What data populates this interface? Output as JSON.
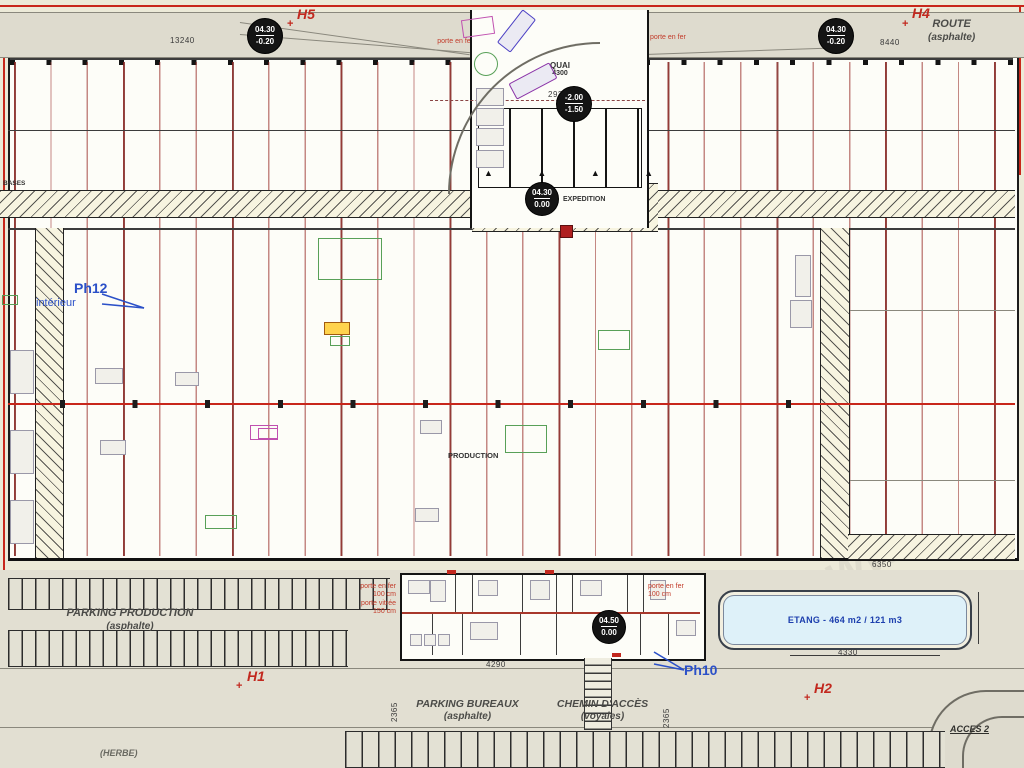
{
  "colors": {
    "accent_red": "#c2281e",
    "grid_red": "#962823",
    "marker_blue": "#2b50c8",
    "pond_fill": "#def1f9",
    "pond_text": "#1d3fae",
    "paper": "#ecead8",
    "asphalt": "#dedbce"
  },
  "watermark": "www",
  "route": {
    "label": "ROUTE",
    "sub": "(asphalte)"
  },
  "markers": {
    "h5": "H5",
    "h4": "H4",
    "h1": "H1",
    "h2": "H2",
    "ph12": "Ph12",
    "ph12_sub": "intérieur",
    "ph10": "Ph10",
    "cross": "+"
  },
  "levels": {
    "top_left": {
      "a": "04.30",
      "b": "-0.20"
    },
    "top_right": {
      "a": "04.30",
      "b": "-0.20"
    },
    "dock": {
      "a": "-2.00",
      "b": "-1.50"
    },
    "entry": {
      "a": "04.30",
      "b": "0.00"
    },
    "bureaux": {
      "a": "04.50",
      "b": "0.00"
    }
  },
  "dims": {
    "top_left": "13240",
    "dock_top": "2922",
    "top_right": "8440",
    "quai": "4300",
    "right_wing": "6350",
    "parking_small": "400",
    "bureaux": "4290",
    "pond": "4330",
    "v_left": "2365",
    "v_right": "2365"
  },
  "doors": {
    "top_left": "porte en fer",
    "top_right": "porte en fer",
    "b_left1": "porte en fer",
    "b_left1s": "100 cm",
    "b_left2": "porte vitrée",
    "b_left2s": "150 cm",
    "b_right": "porte en fer",
    "b_rights": "100 cm"
  },
  "zones": {
    "parking_production": {
      "label": "PARKING PRODUCTION",
      "sub": "(asphalte)"
    },
    "parking_bureaux": {
      "label": "PARKING BUREAUX",
      "sub": "(asphalte)"
    },
    "chemin": {
      "label": "CHEMIN D'ACCÈS",
      "sub": "(voyales)"
    },
    "etang": "ETANG - 464 m2 / 121 m3",
    "acces": "ACCES 2",
    "herbe": "(HERBE)",
    "production": "PRODUCTION",
    "quai": "QUAI",
    "bases": "BASES",
    "expedition": "EXPEDITION"
  },
  "dock_arrows": "▲ ▲ ▲ ▲"
}
